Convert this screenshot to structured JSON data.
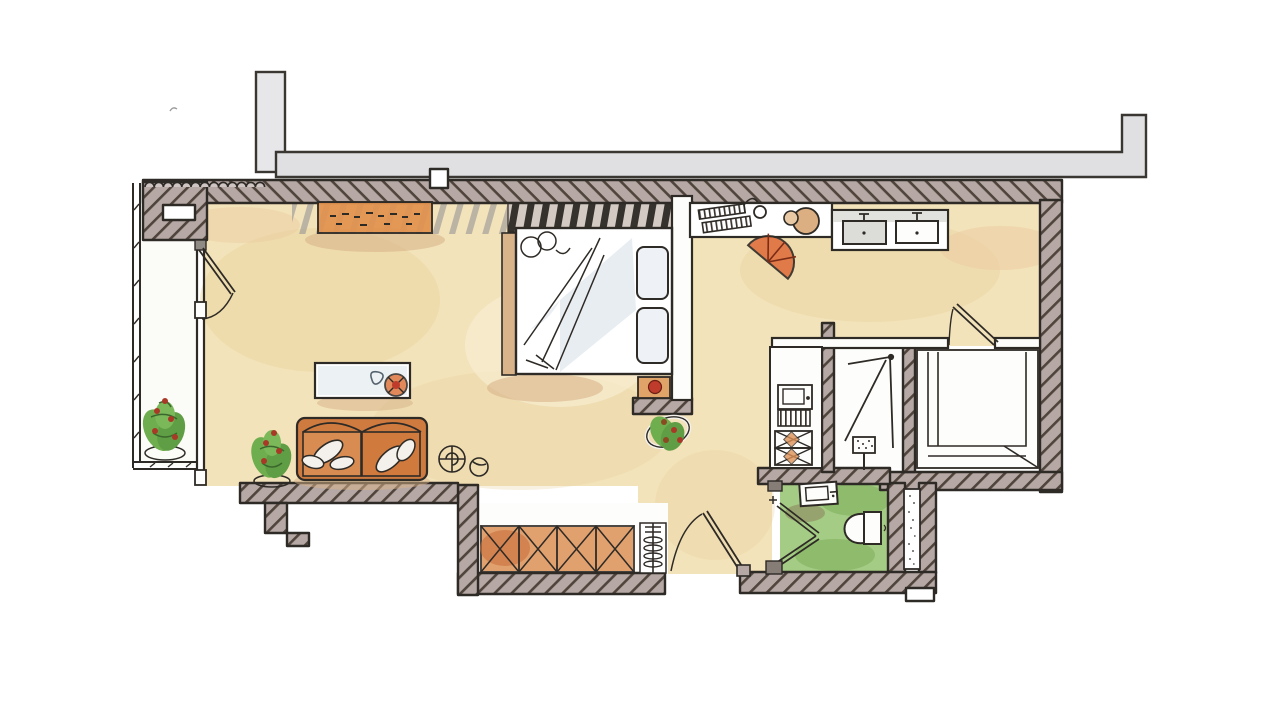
{
  "scene": {
    "kind": "hand-drawn watercolor apartment floor plan",
    "background": "#ffffff"
  },
  "colors": {
    "outline": "#2e2a26",
    "wall_fill": "#b6a8a5",
    "wall_hatch": "#50453c",
    "outer_band": "#e0e0e3",
    "chimney": "#e7e7ea",
    "floor": "#f3e3ba",
    "floor_shade": "#e8d29c",
    "floor_light": "#faf1d8",
    "balcony_floor": "#fbfbf8",
    "room_white": "#fdfdfb",
    "wood": "#e2924e",
    "wood_deep": "#cf7a3e",
    "terracotta": "#dd9157",
    "bench_tan": "#d9b48a",
    "red": "#bf3b2b",
    "green_floor": "#a5cc85",
    "green_shade": "#85b561",
    "leaf": "#6fae4e",
    "leaf_dark": "#4e8c39",
    "berry": "#a83927",
    "bed_wash": "#ccd7e2",
    "gray_wash": "#d9d9d6",
    "stripe_light": "#8e8e92",
    "stripe_dark": "#35312c",
    "stripe_dark_bg": "#d3cbc3"
  },
  "rooms": {
    "balcony": "Balcony",
    "living": "Living room",
    "sleeping": "Sleeping area",
    "work": "Desk area",
    "kitchen": "Kitchenette",
    "shower": "Shower room",
    "walk_in": "Walk-in room",
    "bathroom": "Bathroom",
    "hall": "Entry hall"
  },
  "furniture": {
    "sofa": "Sofa",
    "coffee_table": "Coffee table",
    "sideboard": "Sideboard",
    "bed": "Double bed",
    "nightstand": "Nightstand",
    "desk": "Desk",
    "desk_chair": "Desk chair",
    "stool": "Stool",
    "counter": "Kitchen counter",
    "kitchen_unit": "Kitchen tall unit",
    "closet": "Hall closet",
    "radiator": "Radiator",
    "washbasin": "Washbasin",
    "toilet": "Toilet",
    "duct": "Service shaft",
    "plant": "Potted plant"
  }
}
